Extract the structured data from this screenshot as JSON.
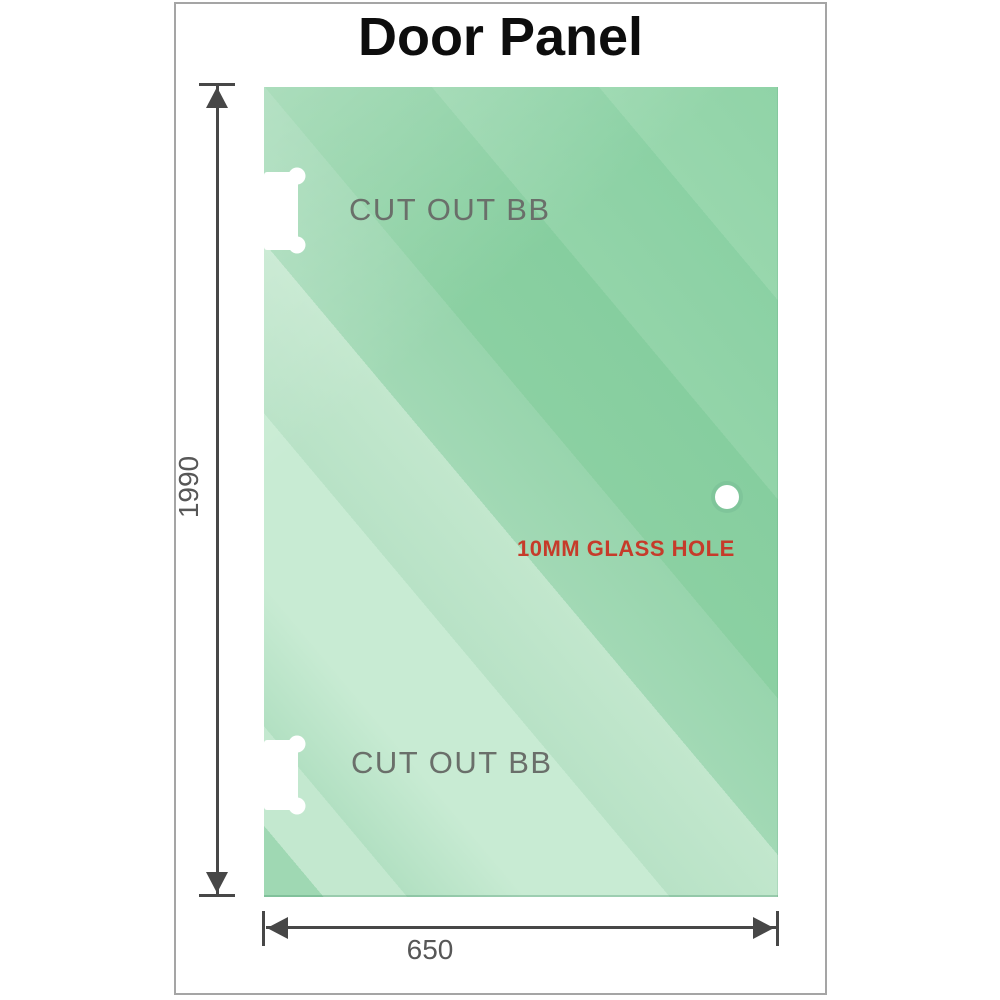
{
  "title": "Door Panel",
  "glass": {
    "cutouts": [
      {
        "label": "CUT OUT BB"
      },
      {
        "label": "CUT OUT BB"
      }
    ],
    "hole_label": "10MM GLASS HOLE"
  },
  "dimensions": {
    "height": "1990",
    "width": "650"
  },
  "colors": {
    "glass_green_dark": "#86ce9f",
    "glass_green_light": "#c8ebd3",
    "dimension_line": "#474747",
    "cutout_text": "#6a6f6a",
    "hole_text_red": "#c63b2a",
    "frame_border": "#a5a5a5",
    "title_text": "#0d0d0d"
  }
}
